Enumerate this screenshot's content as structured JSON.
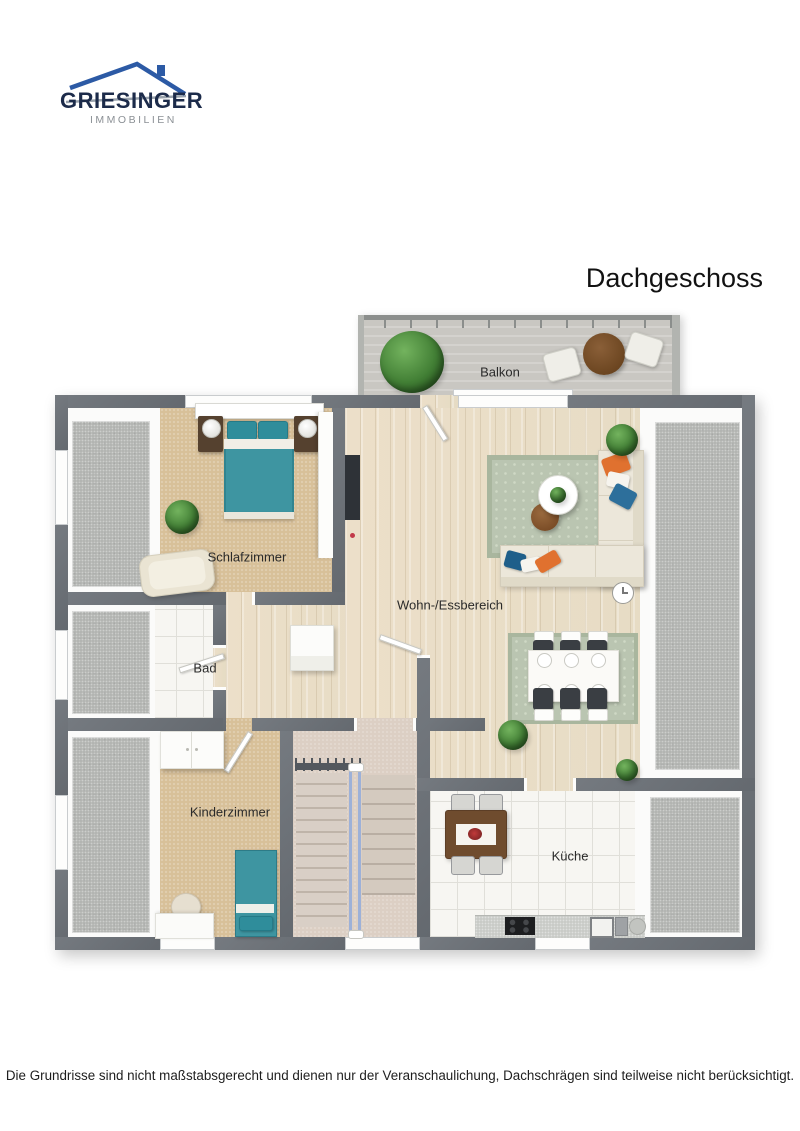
{
  "logo": {
    "name": "GRIESINGER",
    "subtitle": "IMMOBILIEN"
  },
  "title": "Dachgeschoss",
  "disclaimer": "Die Grundrisse sind nicht maßstabsgerecht und dienen nur der Veranschaulichung, Dachschrägen sind teilweise nicht berücksichtigt.",
  "floorplan": {
    "floor_name": "Dachgeschoss",
    "rooms": [
      {
        "id": "balkon",
        "label": "Balkon"
      },
      {
        "id": "schlafzimmer",
        "label": "Schlafzimmer"
      },
      {
        "id": "wohn-essbereich",
        "label": "Wohn-/Essbereich"
      },
      {
        "id": "bad",
        "label": "Bad"
      },
      {
        "id": "kinderzimmer",
        "label": "Kinderzimmer"
      },
      {
        "id": "kueche",
        "label": "Küche"
      }
    ],
    "colors": {
      "wall": "#6c7177",
      "wood_floor": "#e9dfca",
      "carpet_beige": "#d8c099",
      "tile_white": "#f7f6f2",
      "roof_slope_gray": "#b1b3b0",
      "balcony_concrete": "#c9c7c2",
      "stair_carpet": "#dccfc4",
      "furniture_teal": "#3e95a1",
      "accent_orange": "#e0712f",
      "accent_blue": "#2d6f9b",
      "rug_sage": "#bac5b1",
      "logo_navy": "#1c2b4a",
      "logo_blue": "#2c5aa5",
      "logo_gray": "#8b9095"
    }
  }
}
